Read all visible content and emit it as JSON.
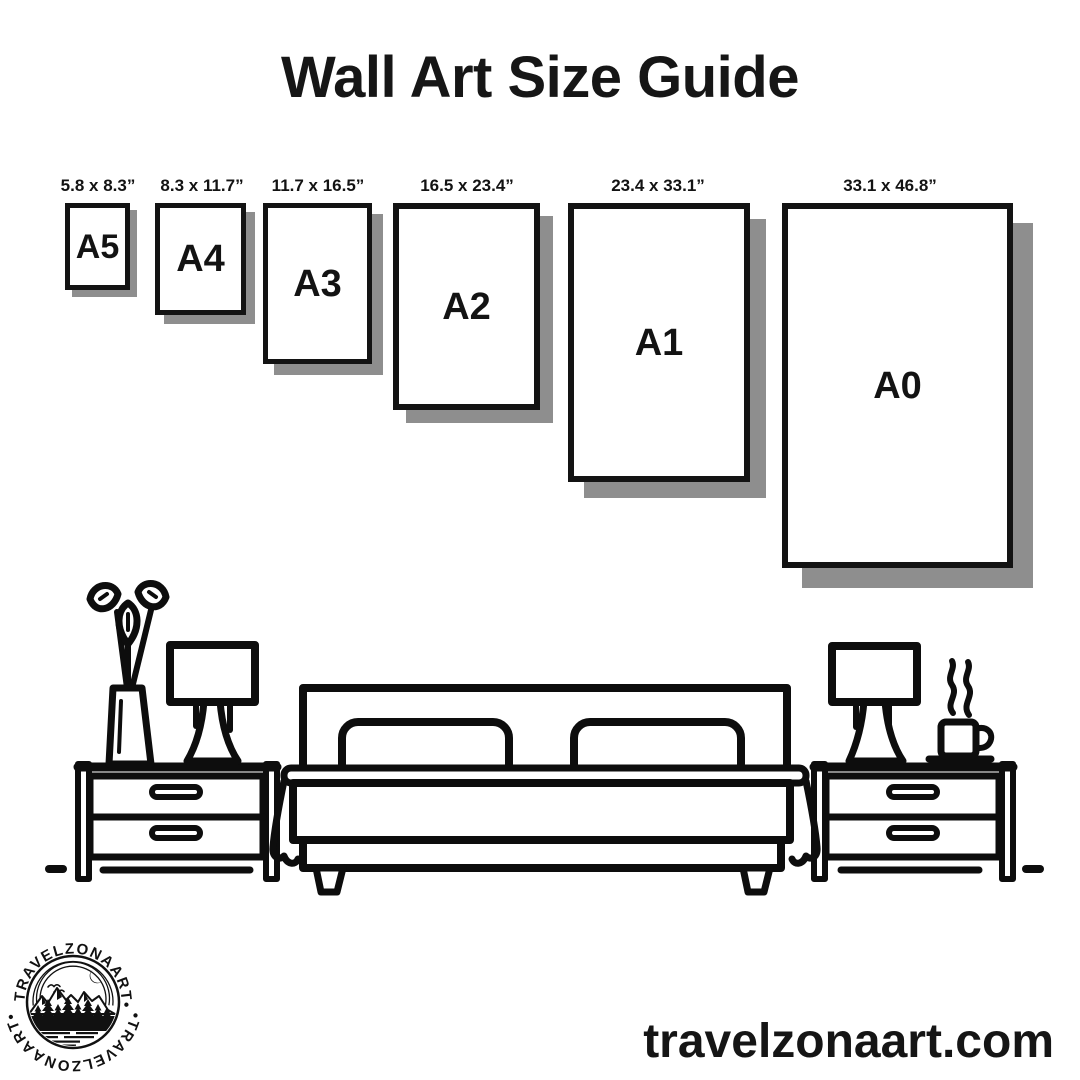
{
  "title": "Wall Art Size Guide",
  "frames": [
    {
      "name": "A5",
      "dimensions": "5.8 x 8.3”"
    },
    {
      "name": "A4",
      "dimensions": "8.3 x 11.7”"
    },
    {
      "name": "A3",
      "dimensions": "11.7 x 16.5”"
    },
    {
      "name": "A2",
      "dimensions": "16.5 x 23.4”"
    },
    {
      "name": "A1",
      "dimensions": "23.4 x 33.1”"
    },
    {
      "name": "A0",
      "dimensions": "33.1 x 46.8”"
    }
  ],
  "logo": {
    "text_top": "•TRAVELZONAART•",
    "text_bottom": "•TRAVELZONAART•"
  },
  "footer": {
    "website": "travelzonaart.com"
  },
  "scene": {
    "icons": [
      "flower-vase-icon",
      "table-lamp-icon",
      "nightstand-icon",
      "double-bed-icon",
      "nightstand-icon",
      "table-lamp-icon",
      "coffee-cup-icon",
      "floor-line"
    ]
  },
  "colors": {
    "ink": "#0d0d0d",
    "shadow": "#8e8e8e",
    "background": "#ffffff"
  }
}
